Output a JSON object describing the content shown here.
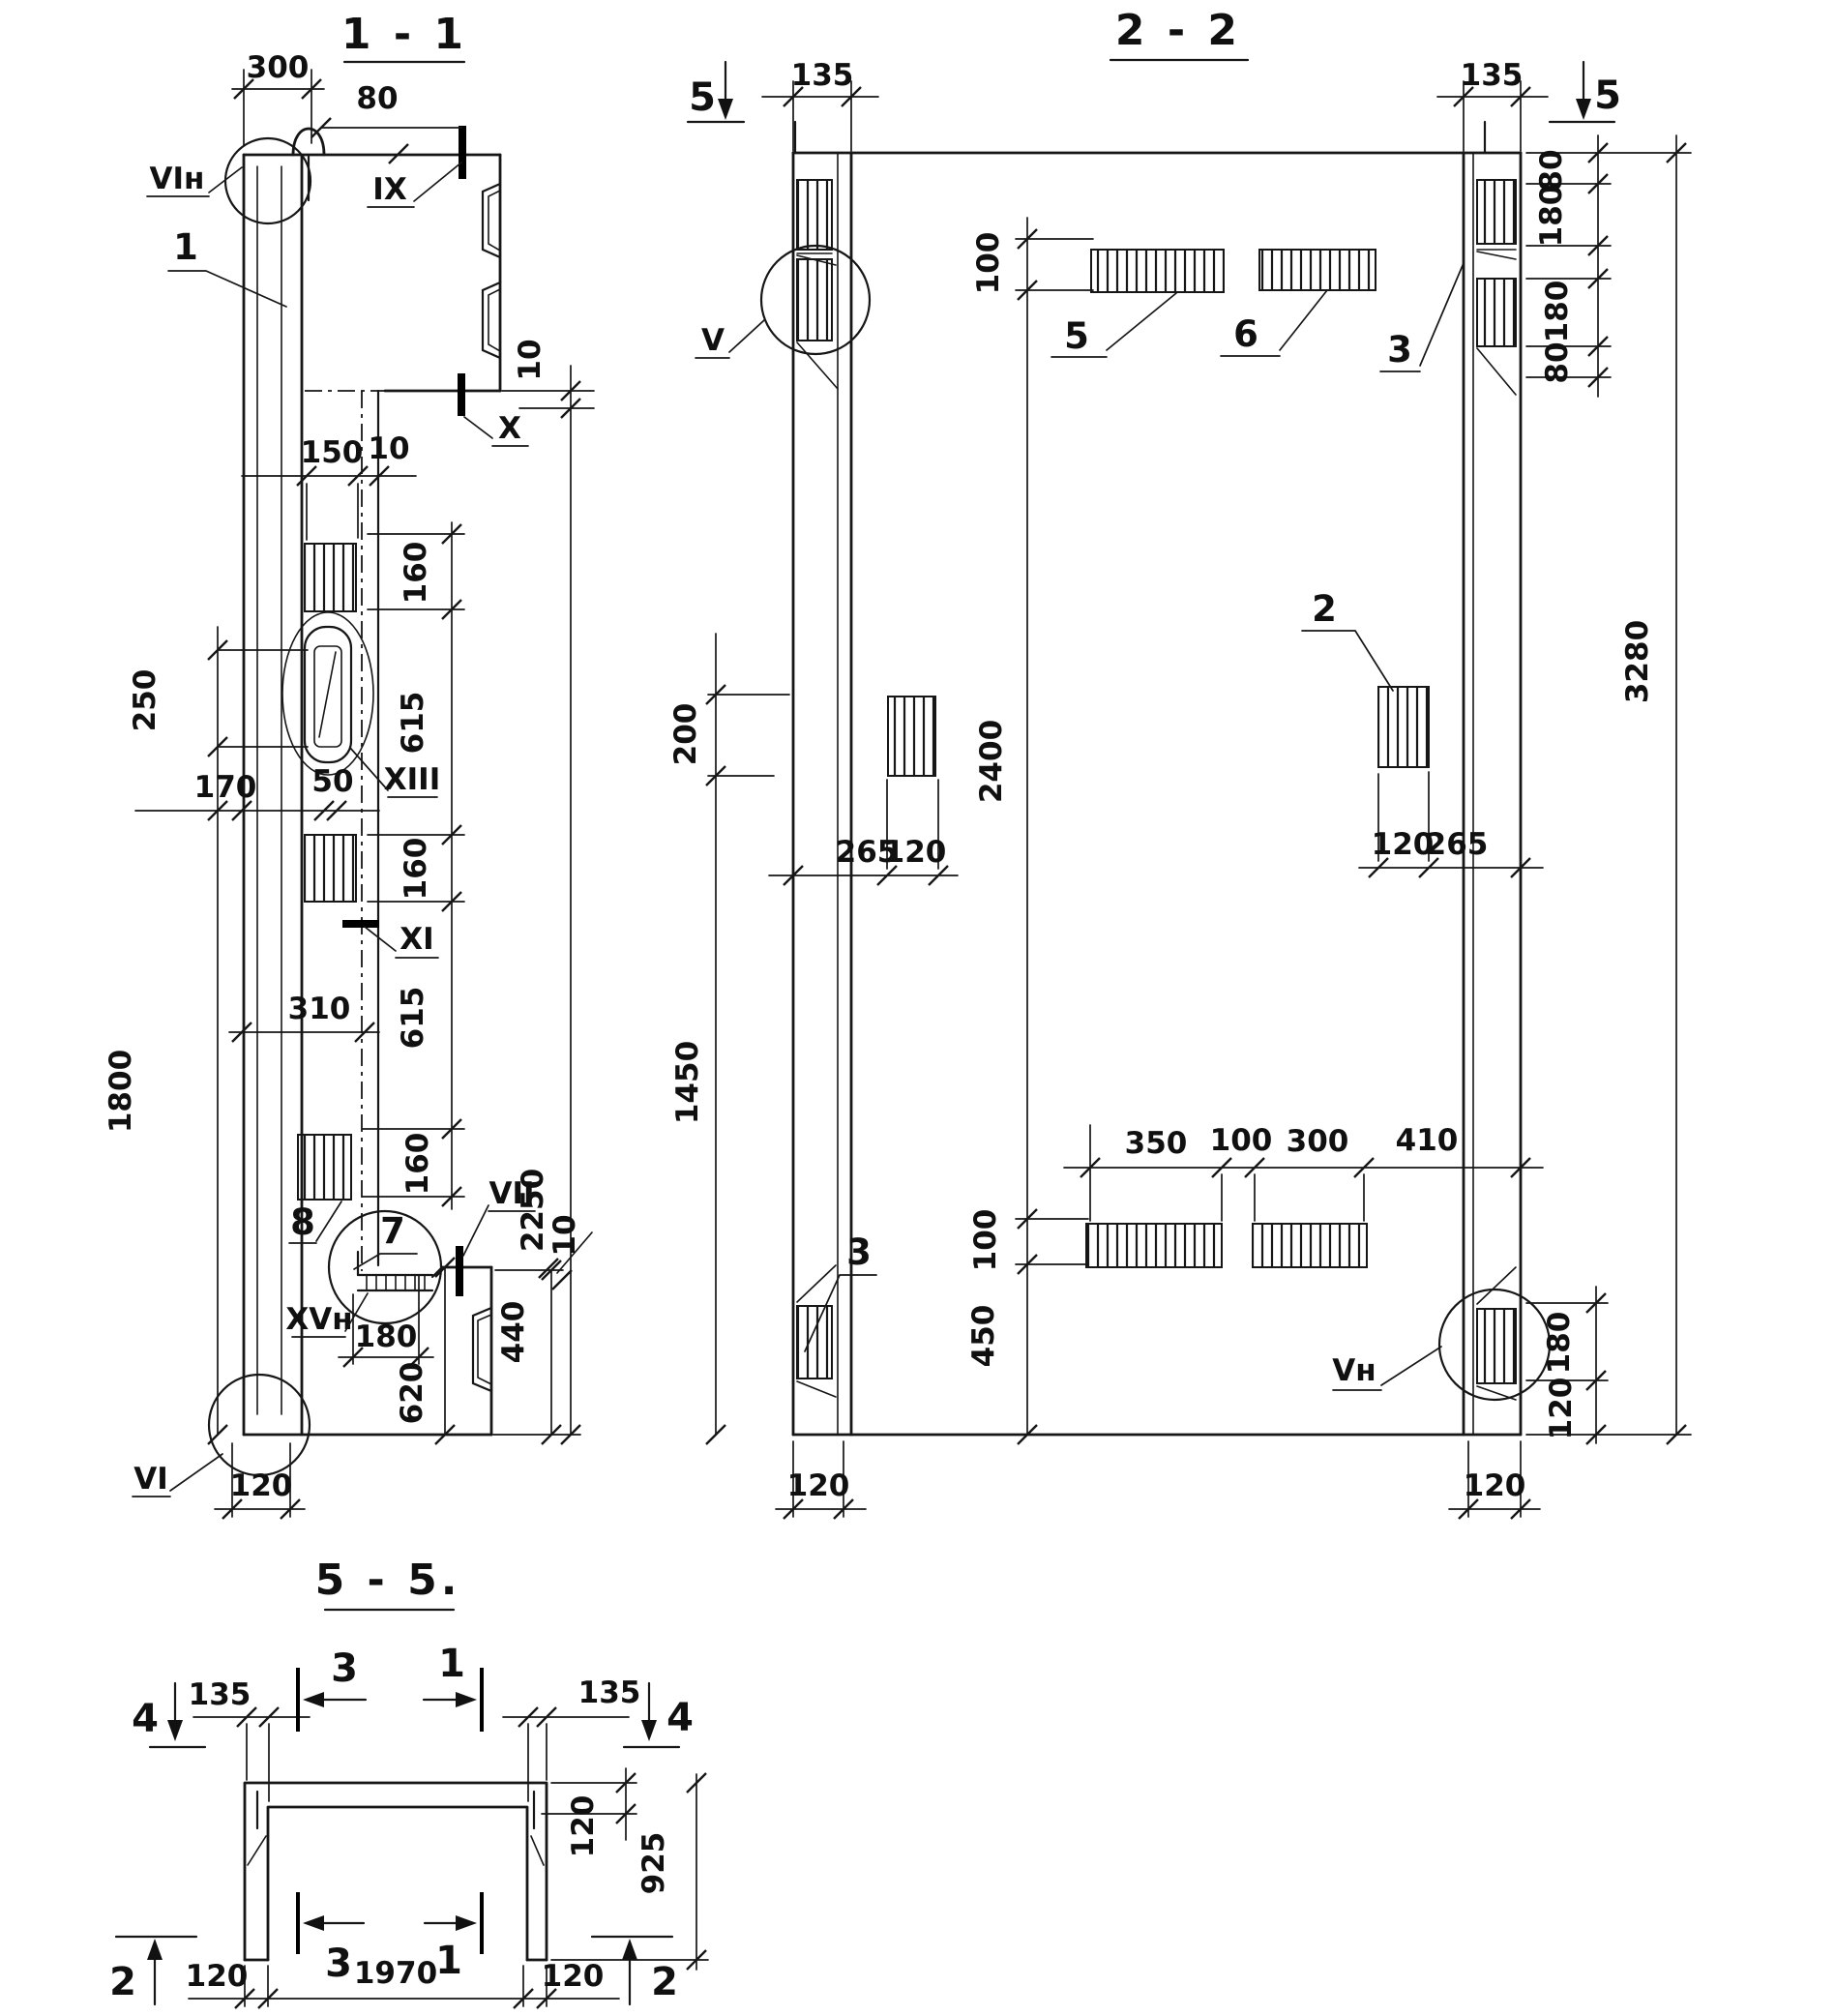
{
  "document": {
    "kind": "structural drawing sheet",
    "background": "#ffffff",
    "ink": "#111111"
  },
  "s11": {
    "title": "1 - 1",
    "dims": {
      "d300": "300",
      "d80": "80",
      "d10t": "10",
      "d150": "150",
      "d10m": "10",
      "d160a": "160",
      "d615a": "615",
      "d160b": "160",
      "d615b": "615",
      "d160c": "160",
      "d250": "250",
      "d170": "170",
      "d50": "50",
      "d310": "310",
      "d1800": "1800",
      "d2250": "2250",
      "d180": "180",
      "d620": "620",
      "d440": "440",
      "d10b": "10",
      "d120": "120"
    },
    "marks": {
      "vin": "VIн",
      "ix": "IX",
      "x": "X",
      "xiii": "XIII",
      "xi": "XI",
      "vii": "VII",
      "xvn": "XVн",
      "vi": "VI"
    },
    "callouts": {
      "c1": "1",
      "c7": "7",
      "c8": "8"
    }
  },
  "s22": {
    "title": "2 - 2",
    "dims": {
      "d135l": "135",
      "d135r": "135",
      "d100t": "100",
      "d80a": "80",
      "d180a": "180",
      "d180b": "180",
      "d80b": "80",
      "d3280": "3280",
      "d200": "200",
      "d2400": "2400",
      "d100b": "100",
      "d450": "450",
      "d1450": "1450",
      "d265l": "265",
      "d120l": "120",
      "d120r": "120",
      "d265r": "265",
      "d350": "350",
      "d100m": "100",
      "d300": "300",
      "d410": "410",
      "d180c": "180",
      "d120rb": "120",
      "d120bl": "120",
      "d120br": "120"
    },
    "marks": {
      "s5l": "5",
      "s5r": "5",
      "v": "V",
      "vn": "Vн"
    },
    "callouts": {
      "c5": "5",
      "c6": "6",
      "c2": "2",
      "c3l": "3",
      "c3r": "3"
    }
  },
  "s55": {
    "title": "5 - 5.",
    "dims": {
      "d135l": "135",
      "d135r": "135",
      "d120t": "120",
      "d925": "925",
      "d120bl": "120",
      "d1970": "1970",
      "d120br": "120"
    },
    "marks": {
      "m4l": "4",
      "m4r": "4",
      "m3t": "3",
      "m1t": "1",
      "m3b": "3",
      "m1b": "1",
      "m2l": "2",
      "m2r": "2"
    }
  }
}
